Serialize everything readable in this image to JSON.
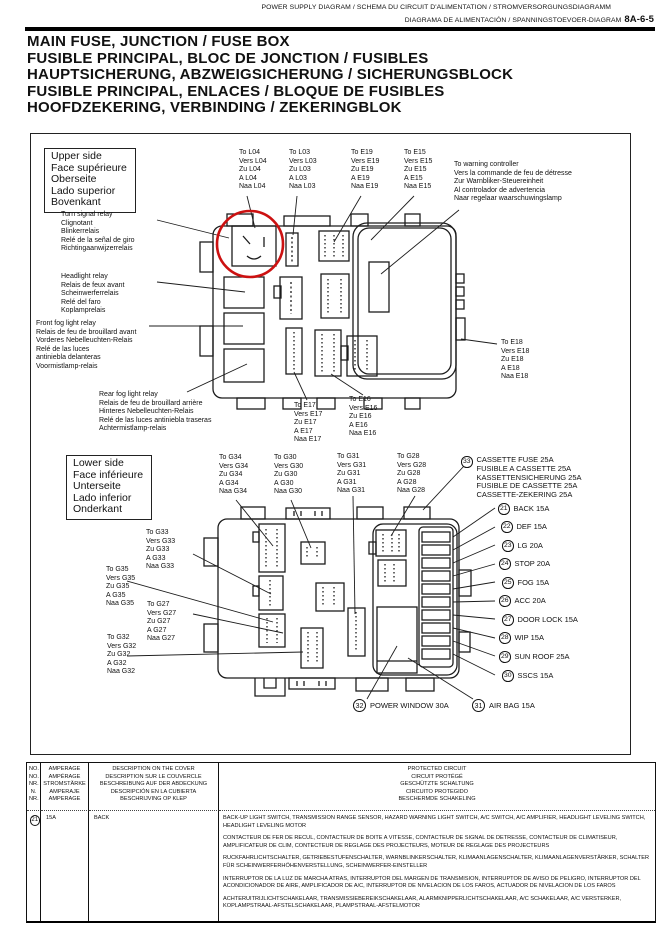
{
  "header": {
    "line1": "POWER SUPPLY DIAGRAM / SCHEMA DU CIRCUIT D'ALIMENTATION / STROMVERSORGUNGSDIAGRAMM",
    "line2": "DIAGRAMA DE ALIMENTACIÓN / SPANNINGSTOEVOER-DIAGRAM",
    "page_number": "8A-6-5"
  },
  "title": "MAIN FUSE, JUNCTION / FUSE BOX\nFUSIBLE PRINCIPAL, BLOC DE JONCTION / FUSIBLES\nHAUPTSICHERUNG, ABZWEIGSICHERUNG / SICHERUNGSBLOCK\nFUSIBLE PRINCIPAL, ENLACES / BLOQUE DE FUSIBLES\nHOOFDZEKERING, VERBINDING / ZEKERINGBLOK",
  "diagram": {
    "upper_side": "Upper side\nFace supérieure\nOberseite\nLado superior\nBovenkant",
    "lower_side": "Lower side\nFace inférieure\nUnterseite\nLado inferior\nOnderkant",
    "turn_signal_relay": "Turn signal relay\nClignotant\nBlinkerrelais\nRelé de la señal de giro\nRichtingaanwijzerrelais",
    "headlight_relay": "Headlight relay\nRelais de feux avant\nScheinwerferrelais\nRelé del faro\nKoplamprelais",
    "front_fog_relay": "Front fog light relay\nRelais de feu de brouillard avant\nVorderes Nebelleuchten-Relais\nRelé de las luces\n      antiniebla delanteras\nVoormistlamp-relais",
    "rear_fog_relay": "Rear fog light relay\nRelais de feu de brouillard arrière\nHinteres Nebelleuchten-Relais\nRelé de las luces antiniebla traseras\nAchtermistlamp-relais",
    "warning_controller": "To warning controller\nVers la commande de feu de détresse\nZur Warnbliker-Steuereinheit\nAl controlador de advertencia\nNaar regelaar waarschuwingslamp",
    "conn": {
      "l04": "To L04\nVers L04\nZu L04\nA L04\nNaa L04",
      "l03": "To L03\nVers L03\nZu L03\nA L03\nNaa L03",
      "e19": "To E19\nVers E19\nZu E19\nA E19\nNaa E19",
      "e15": "To E15\nVers E15\nZu E15\nA E15\nNaa E15",
      "e18": "To E18\nVers E18\nZu E18\nA E18\nNaa E18",
      "e17": "To E17\nVers E17\nZu E17\nA E17\nNaa E17",
      "e16": "To E16\nVers E16\nZu E16\nA E16\nNaa E16",
      "g34": "To G34\nVers G34\nZu G34\nA G34\nNaa G34",
      "g30": "To G30\nVers G30\nZu G30\nA G30\nNaa G30",
      "g31": "To G31\nVers G31\nZu G31\nA G31\nNaa G31",
      "g28": "To G28\nVers G28\nZu G28\nA G28\nNaa G28",
      "g33": "To G33\nVers G33\nZu G33\nA G33\nNaa G33",
      "g35": "To G35\nVers G35\nZu G35\nA G35\nNaa G35",
      "g27": "To G27\nVers G27\nZu G27\nA G27\nNaa G27",
      "g32": "To G32\nVers G32\nZu G32\nA G32\nNaa G32"
    },
    "cassette_fuse": {
      "no": "33",
      "label": "CASSETTE FUSE 25A\nFUSIBLE A CASSETTE 25A\nKASSETTENSICHERUNG 25A\nFUSIBLE DE CASSETTE 25A\nCASSETTE-ZEKERING 25A"
    },
    "fuse_list": [
      {
        "no": "21",
        "label": "BACK 15A"
      },
      {
        "no": "22",
        "label": "DEF 15A"
      },
      {
        "no": "23",
        "label": "LG 20A"
      },
      {
        "no": "24",
        "label": "STOP 20A"
      },
      {
        "no": "25",
        "label": "FOG 15A"
      },
      {
        "no": "26",
        "label": "ACC 20A"
      },
      {
        "no": "27",
        "label": "DOOR LOCK 15A"
      },
      {
        "no": "28",
        "label": "WIP 15A"
      },
      {
        "no": "29",
        "label": "SUN ROOF 25A"
      },
      {
        "no": "30",
        "label": "SSCS 15A"
      }
    ],
    "power_window": {
      "no": "32",
      "label": "POWER WINDOW 30A"
    },
    "air_bag": {
      "no": "31",
      "label": "AIR BAG 15A"
    },
    "red_circle_color": "#cc1111"
  },
  "table": {
    "headers": {
      "no": "NO.\nNO.\nNR.\nN.\nNR.",
      "amperage": "AMPERAGE\nAMPÉRAGE\nSTROMSTÄRKE\nAMPERAJE\nAMPERAGE",
      "description": "DESCRIPTION ON THE COVER\nDESCRIPTION SUR LE COUVERCLE\nBESCHREIBUNG AUF DER ABDECKUNG\nDESCRIPCIÓN EN LA CUBIERTA\nBESCHRIJVING OP KLEP",
      "protected": "PROTECTED CIRCUIT\nCIRCUIT PROTÉGÉ\nGESCHÜTZTE SCHALTUNG\nCIRCUITO PROTEGIDO\nBESCHERMDE SCHAKELING"
    },
    "row": {
      "no": "21",
      "amperage": "15A",
      "description": "BACK",
      "protected_en": "BACK-UP LIGHT SWITCH, TRANSMISSION RANGE SENSOR, HAZARD WARNING LIGHT SWITCH, A/C SWITCH, A/C AMPLIFIER, HEADLIGHT LEVELING SWITCH, HEADLIGHT LEVELING MOTOR",
      "protected_fr": "CONTACTEUR DE FER DE RECUL, CONTACTEUR DE BOITE A VITESSE, CONTACTEUR DE SIGNAL DE DETRESSE, CONTACTEUR DE CLIMATISEUR, AMPLIFICATEUR DE CLIM, CONTECTEUR DE REGLAGE DES PROJECTEURS, MOTEUR DE REGLAGE DES PROJECTEURS",
      "protected_de": "RUCKFAHRLICHTSCHALTER, GETRIEBESTUFENSCHALTER, WARNBLINKERSCHALTER, KLIMAANLAGENSCHALTER, KLIMAANLAGENVERSTÄRKER, SCHALTER FÜR SCHEINWERFERHÖHENVERSTELLUNG, SCHEINWERFER-EINSTELLER",
      "protected_es": "INTERRUPTOR DE LA LUZ DE MARCHA ATRAS, INTERRUPTOR DEL MARGEN DE TRANSMISION, INTERRUPTOR DE AVISO DE PELIGRO, INTERRUPTOR DEL ACONDICIONADOR DE AIRE, AMPLIFICADOR DE A/C, INTERRUPTOR DE NIVELACION DE LOS FAROS, ACTUADOR DE NIVELACION DE LOS FAROS",
      "protected_nl": "ACHTERUITRIJLICHTSCHAKELAAR, TRANSMISSIEBEREIKSCHAKELAAR, ALARMKNIPPERLICHTSCHAKELAAR, A/C SCHAKELAAR, A/C VERSTERKER, KOPLAMPSTRAAL-AFSTELSCHAKELAAR, PLAMPSTRAAL-AFSTELMOTOR"
    }
  }
}
